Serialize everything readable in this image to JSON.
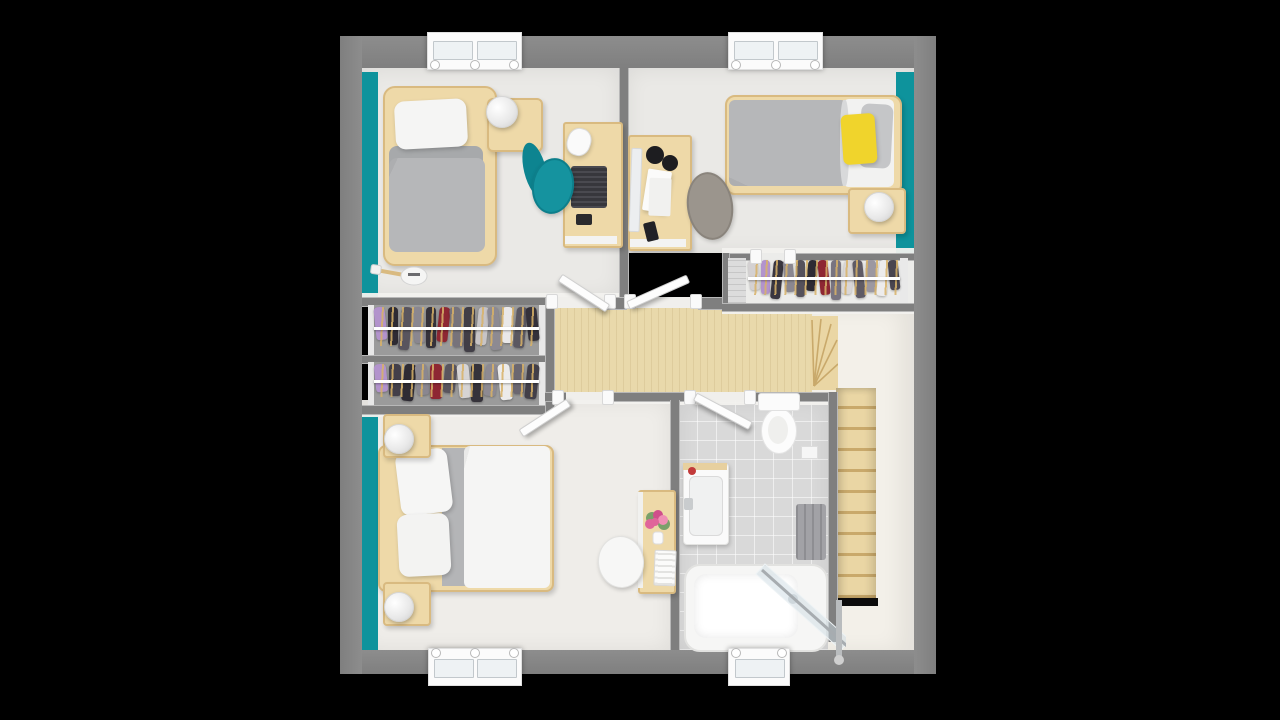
{
  "scene": {
    "type": "floor-plan-3d-render",
    "view": "top-down",
    "background": "#000000",
    "rooms": [
      "bedroom-top-left",
      "bedroom-top-right",
      "walk-in-closet",
      "hallway-landing",
      "wardrobe-closets",
      "master-bedroom",
      "bathroom",
      "staircase"
    ]
  },
  "palette": {
    "wall": "#7f7f7f",
    "wall-light": "#8d8d8d",
    "floor": "#eae9e6",
    "floor-warm": "#efede9",
    "cream": "#f3f0e9",
    "teal": "#0e939c",
    "woodfloor": "#e9d9ab",
    "wood": "#eed9a8",
    "wood-edge": "#d9ba80",
    "duvet": "#b6b7b9",
    "linen": "#f5f5f4",
    "yellow": "#f0d42c",
    "tile": "#d9d9d9",
    "chairteal": "#15939f",
    "taupe": "#9b958d",
    "towel": "#a2a2a6",
    "hanger": "#d8b268",
    "stairwood": "#ead6a4",
    "stairedge": "#c9a96b",
    "rail": "#ffffff",
    "gap": "#0c0c0c",
    "flower": "#e0659a"
  },
  "closets": {
    "racks": [
      {
        "name": "wardrobe-rack-top",
        "items": [
          "#b293cc",
          "#2e2b33",
          "#59555e",
          "#8a8790",
          "#35323a",
          "#8e2733",
          "#77737b",
          "#413e46",
          "#c7c4c6",
          "#8d8a92",
          "#e9e8e8",
          "#5b5861",
          "#34313a"
        ]
      },
      {
        "name": "wardrobe-rack-bottom",
        "items": [
          "#b293cc",
          "#433f49",
          "#2e2b33",
          "#8a8790",
          "#8e2733",
          "#59555e",
          "#d6d4d4",
          "#35323a",
          "#8d8a92",
          "#ecebea",
          "#6b6770",
          "#423f48"
        ]
      },
      {
        "name": "walkin-closet-rack",
        "items": [
          "#d4d1d2",
          "#b293cc",
          "#39363f",
          "#8a8790",
          "#55515b",
          "#2e2b33",
          "#8e2733",
          "#787480",
          "#d9d6d6",
          "#5f5b65",
          "#9c98a1",
          "#edecec",
          "#49454f"
        ]
      }
    ]
  },
  "stairs": {
    "straight_steps": 10,
    "winder_steps": 5
  },
  "windows": {
    "top_count": 2,
    "bottom_count": 2,
    "knobs_per_window": [
      3,
      3,
      3,
      2
    ]
  }
}
